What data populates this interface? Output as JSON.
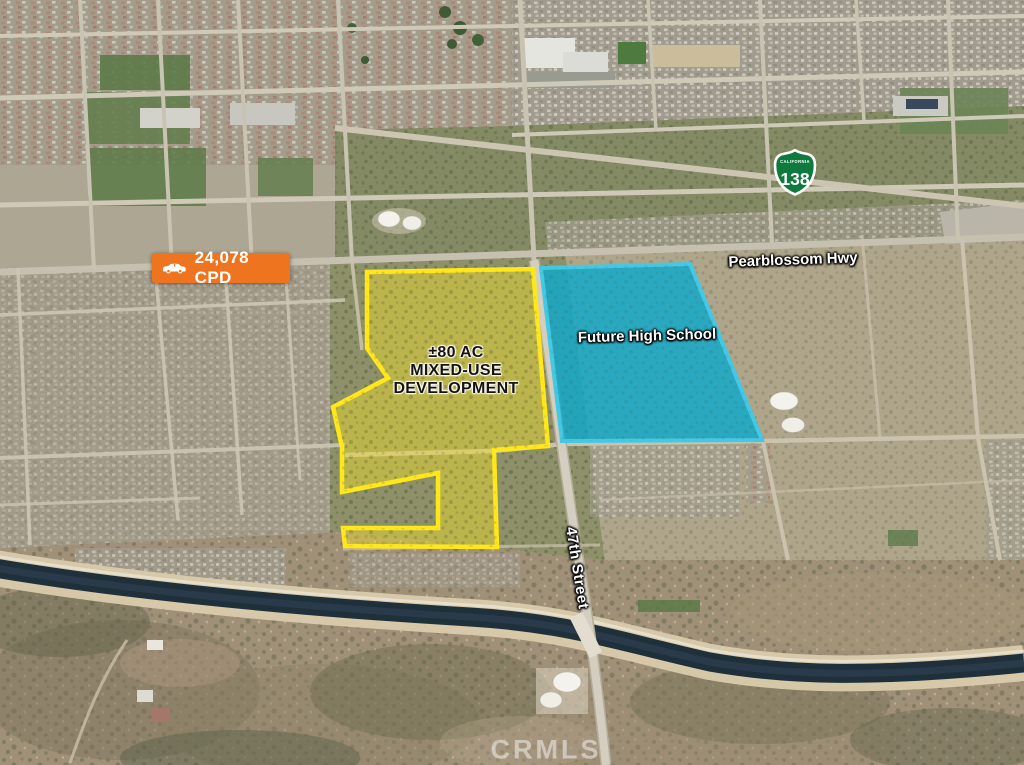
{
  "traffic_badge": {
    "label": "24,078 CPD",
    "icon": "car-icon",
    "bg_color": "#ee7420"
  },
  "highway_shield": {
    "state": "CALIFORNIA",
    "route": "138",
    "color": "#0f7a3e"
  },
  "road_labels": {
    "pearblossom": "Pearblossom Hwy",
    "street_47": "47th Street"
  },
  "parcels": {
    "mixed_use": {
      "line1": "±80 AC",
      "line2": "MIXED-USE",
      "line3": "DEVELOPMENT",
      "outline_color": "#ffe71a",
      "fill_color": "#e8d831"
    },
    "high_school": {
      "label": "Future High School",
      "outline_color": "#43c8e6",
      "fill_color": "#12a8c8"
    }
  },
  "watermark": "CRMLS"
}
